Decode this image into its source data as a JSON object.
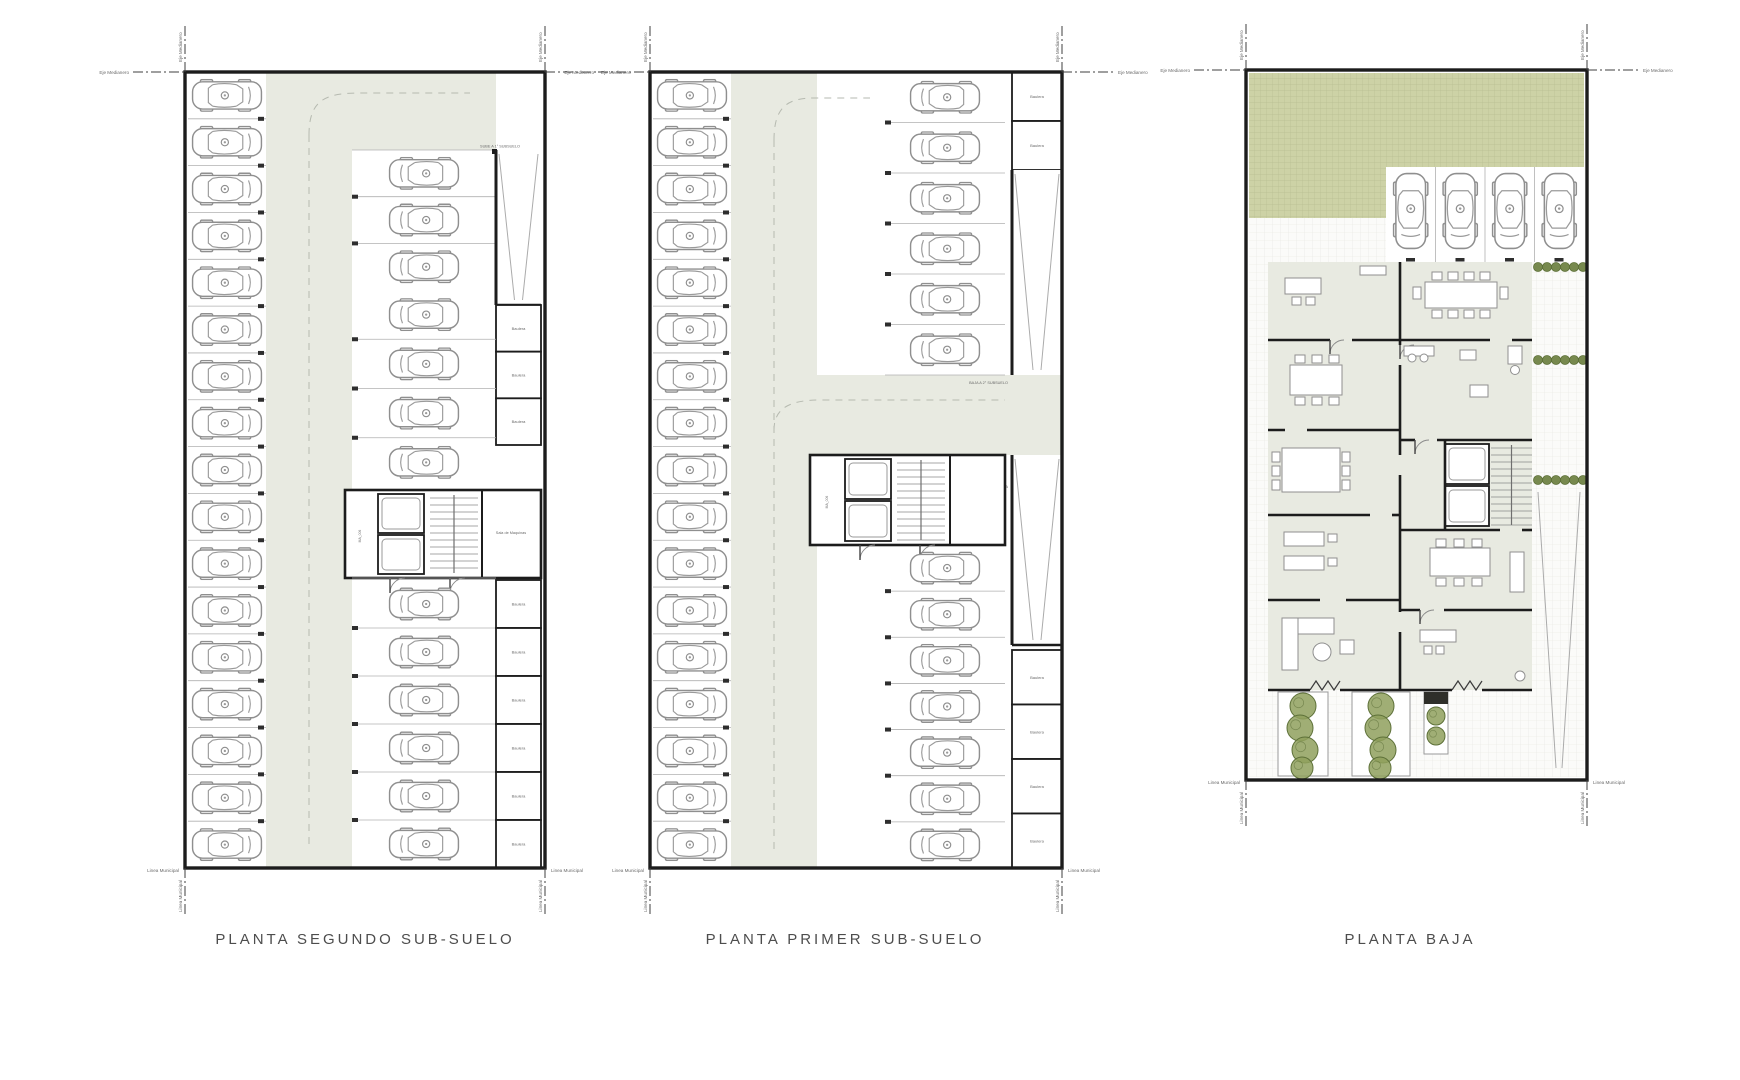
{
  "drawing": {
    "sheet_background": "#ffffff",
    "boundary": {
      "party_axis_label": "Eje Medianero",
      "municipal_line_label": "Linea Municipal"
    },
    "plans": [
      {
        "id": "segundo_subsuelo",
        "title": "PLANTA SEGUNDO SUB-SUELO",
        "labels": {
          "ramp_up": "SUBE A 1° SUBSUELO",
          "machine_room": "Sala de Maquinas",
          "elevator_tag": "MA_006",
          "storage": "Baulera"
        },
        "parking": {
          "left_rows": 17,
          "right_upper_rows": 3,
          "right_middle_rows": 4,
          "right_lower_rows": 6
        },
        "storage": {
          "upper_cells": 3,
          "lower_cells": 6
        }
      },
      {
        "id": "primer_subsuelo",
        "title": "PLANTA PRIMER SUB-SUELO",
        "labels": {
          "ramp_down": "BAJA A 2° SUBSUELO",
          "ramp_up": "SUBE A PLANTA BAJA",
          "elevator_tag": "MA_006",
          "storage": "Baulera"
        },
        "parking": {
          "left_rows": 17,
          "right_upper_rows": 6,
          "right_lower_rows": 7
        },
        "storage": {
          "top_cells": 2,
          "lower_cells": 4
        }
      },
      {
        "id": "planta_baja",
        "title": "PLANTA BAJA",
        "parking": {
          "stalls": 4
        }
      }
    ],
    "colors": {
      "wall": "#1c1c1c",
      "aisle": "#e8eae1",
      "lawn": "#cdd2a6",
      "lawn_grid": "#b8bf92",
      "pave": "#e6e6e0",
      "plant": "#77894e",
      "plant_dark": "#5d7038",
      "tree": "#8fa05d",
      "car_line": "#8f8f8f",
      "dash_guide": "#b6bab0",
      "divider": "#b0b0b0",
      "text": "#6a6a6a",
      "boundary_line": "#3f3f3f"
    }
  }
}
